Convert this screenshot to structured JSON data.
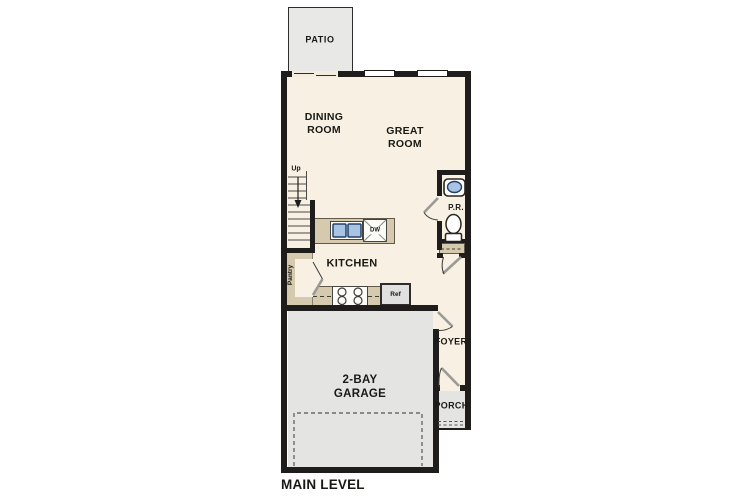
{
  "floor_plan": {
    "level_label": "MAIN LEVEL",
    "rooms": {
      "patio": "PATIO",
      "dining_room": "DINING\nROOM",
      "great_room": "GREAT\nROOM",
      "kitchen": "KITCHEN",
      "pantry": "Pantry",
      "powder_room": "P.R.",
      "foyer": "FOYER",
      "porch": "PORCH",
      "garage": "2-BAY\nGARAGE"
    },
    "stairs": {
      "direction_label": "Up"
    },
    "appliances": {
      "dishwasher": "DW",
      "refrigerator": "Ref"
    },
    "colors": {
      "wall": "#1e1d1b",
      "interior": "#f8f0e2",
      "outdoor_concrete": "#e5e5e3",
      "counter_tan": "#d5c9ae",
      "sink_blue": "#a8c4e2"
    }
  }
}
